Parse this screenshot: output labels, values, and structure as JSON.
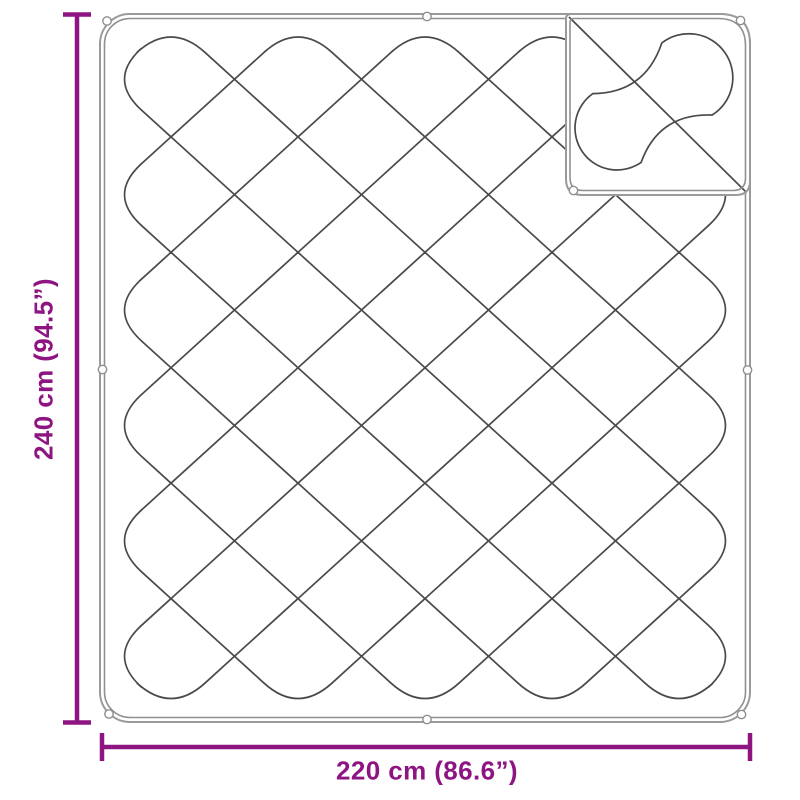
{
  "diagram": {
    "name": "quilted-blanket-dimension-diagram",
    "description": "Top-view line drawing of a quilted blanket with diamond stitching, corner and mid-edge tie loops, and a folded-over top-right corner showing the reverse side",
    "grid": {
      "columns": 5,
      "rows": 6
    }
  },
  "dimensions": {
    "height": {
      "label": "240 cm (94.5”)"
    },
    "width": {
      "label": "220 cm (86.6”)"
    }
  },
  "colors": {
    "dimension": "#8E1482",
    "stitch_line": "#4a4a4a",
    "border_outer": "#9a9a9a",
    "border_inner": "#8f8f8f",
    "background": "#ffffff"
  }
}
